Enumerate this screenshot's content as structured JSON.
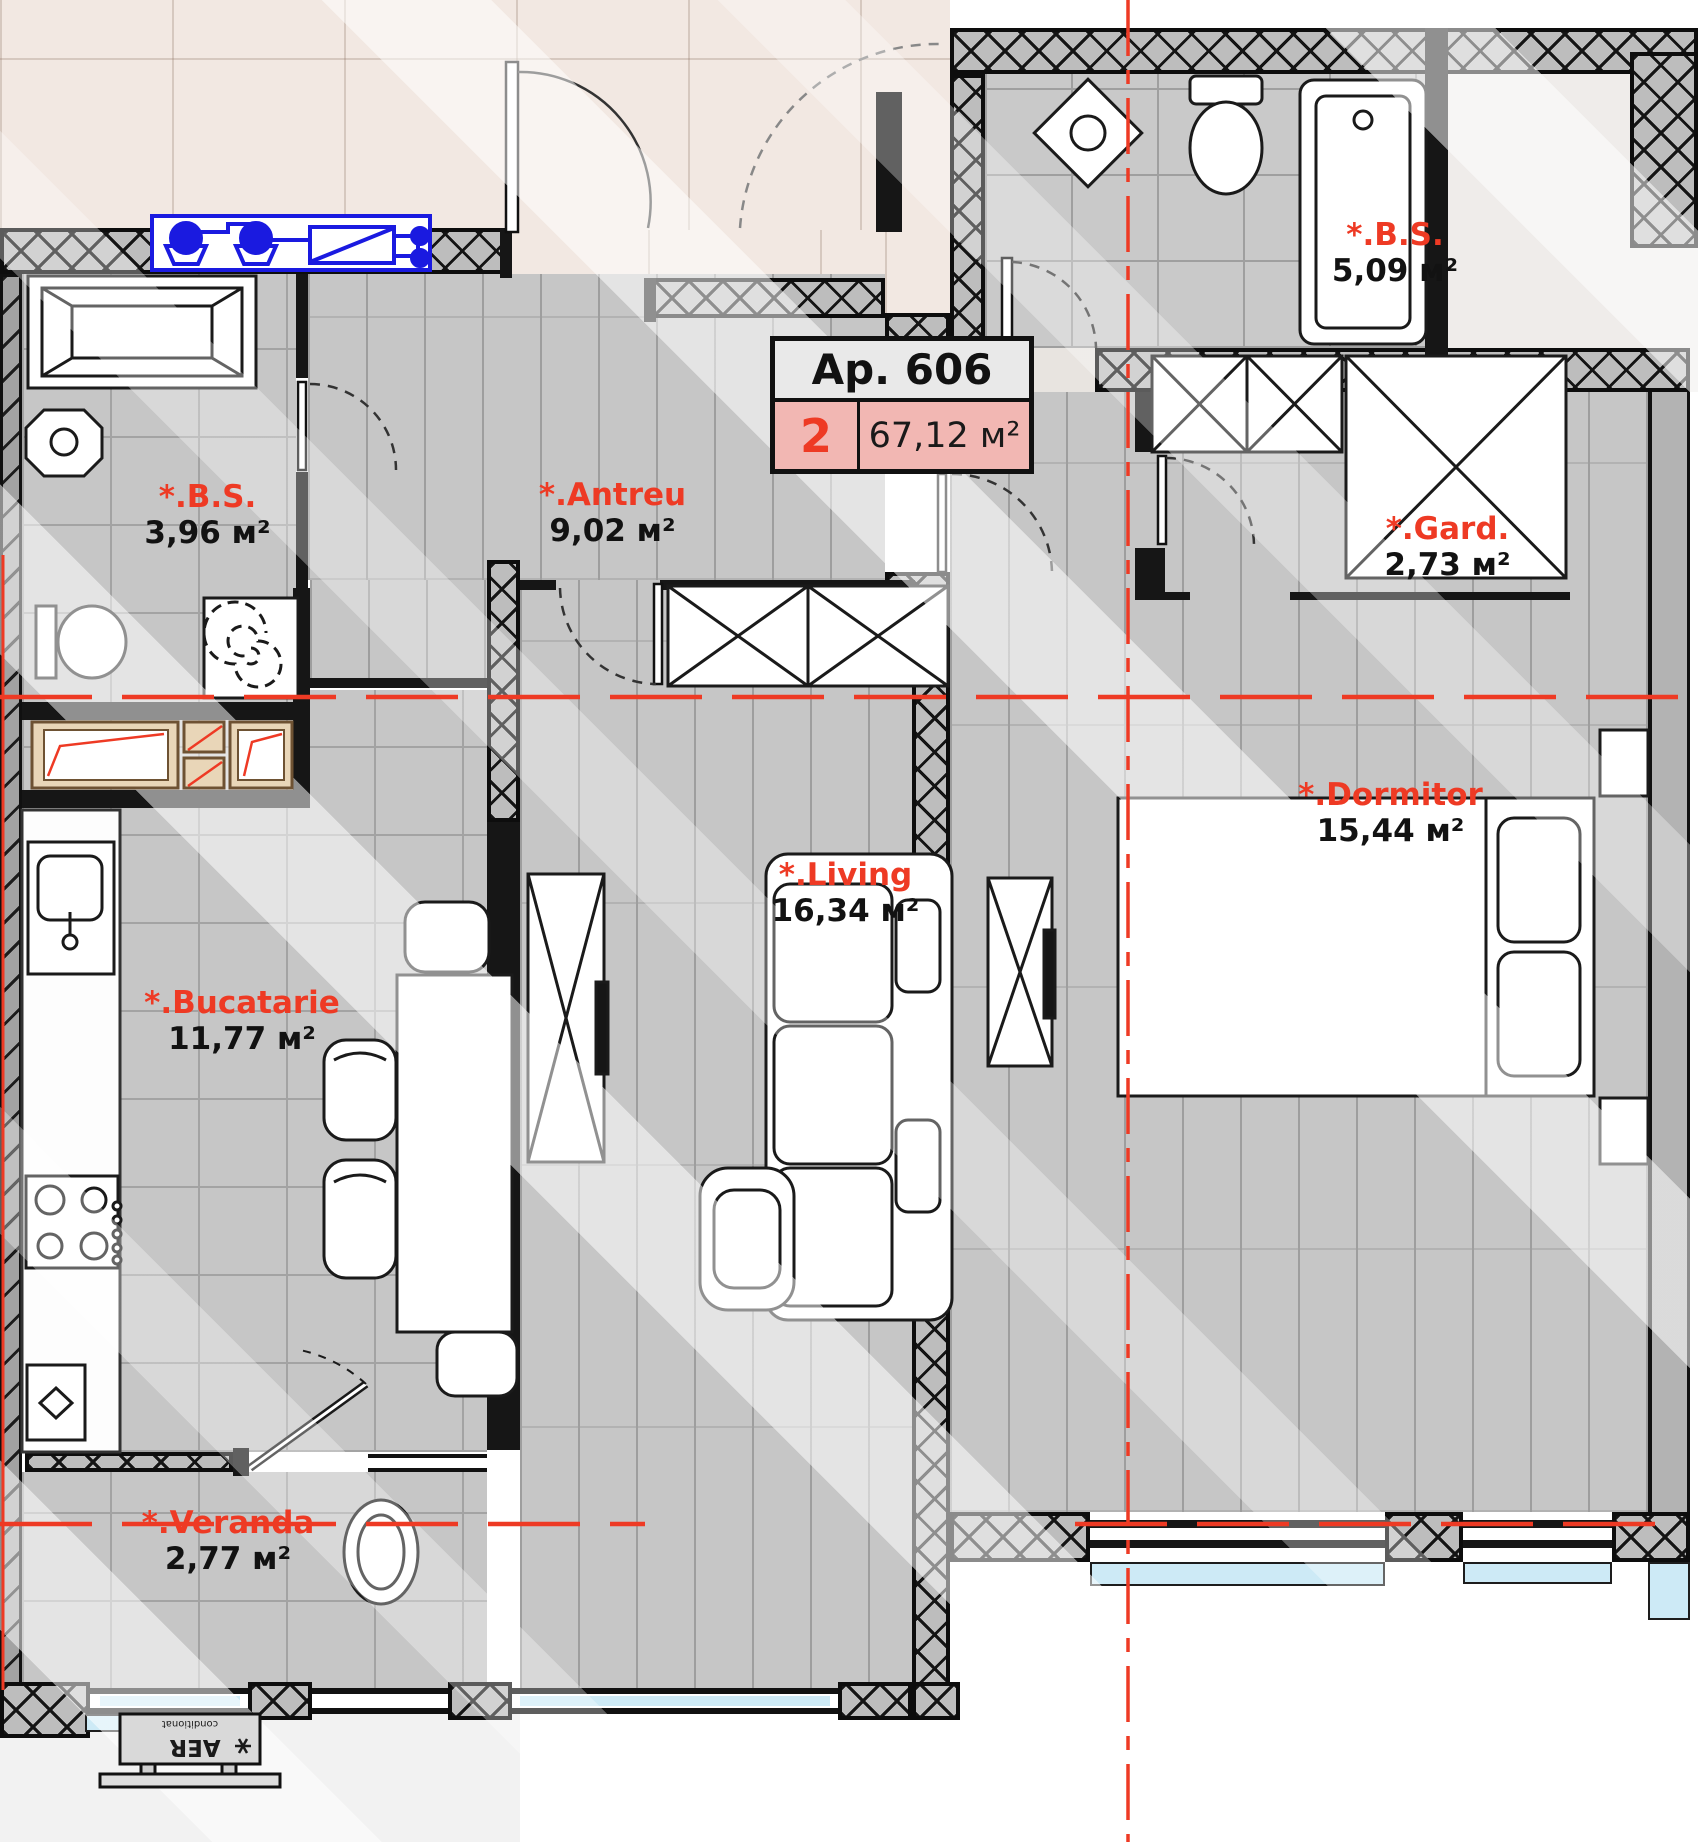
{
  "plan": {
    "title_box": {
      "title": "Ap. 606",
      "rooms_count": "2",
      "total_area": "67,12 м²"
    },
    "rooms": [
      {
        "name": "bs-upper",
        "label": "*.B.S.",
        "area": "5,09 м²"
      },
      {
        "name": "bs-lower",
        "label": "*.B.S.",
        "area": "3,96 м²"
      },
      {
        "name": "antreu",
        "label": "*.Antreu",
        "area": "9,02 м²"
      },
      {
        "name": "gard",
        "label": "*.Gard.",
        "area": "2,73 м²"
      },
      {
        "name": "dormitor",
        "label": "*.Dormitor",
        "area": "15,44 м²"
      },
      {
        "name": "living",
        "label": "*.Living",
        "area": "16,34 м²"
      },
      {
        "name": "bucatarie",
        "label": "*.Bucatarie",
        "area": "11,77 м²"
      },
      {
        "name": "veranda",
        "label": "*.Veranda",
        "area": "2,77 м²"
      }
    ],
    "ac_unit": {
      "line_big": "AER",
      "line_small": "conditionat",
      "icon": "snowflake-icon"
    },
    "colors": {
      "label_red": "#ee3a24",
      "highlight_pink": "#f2b7b3",
      "schematic_blue": "#1a1ae0",
      "glass_blue": "#cdeaf6",
      "shaft_tan": "#e9d6b8"
    }
  }
}
